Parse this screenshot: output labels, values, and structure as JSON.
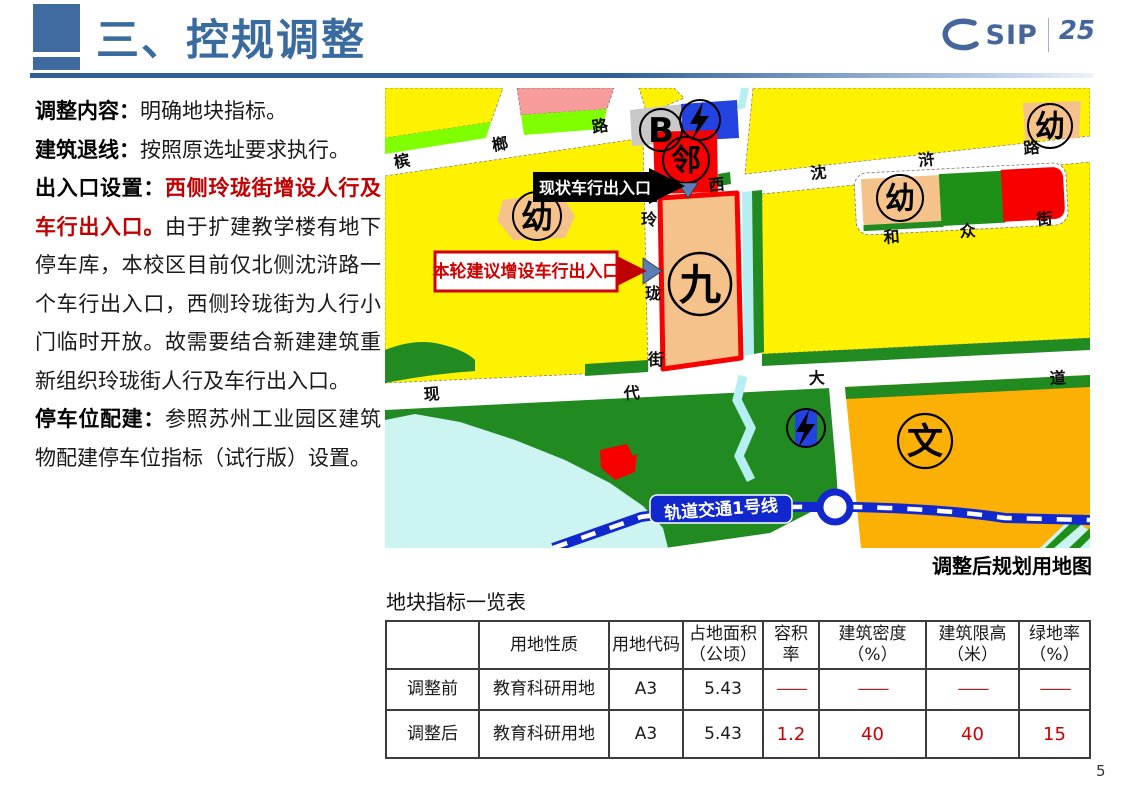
{
  "header": {
    "title": "三、控规调整",
    "logo_brand": "SIP",
    "logo_anniversary": "25"
  },
  "left_column": {
    "paragraphs": [
      {
        "segments": [
          {
            "t": "调整内容：",
            "s": "bold"
          },
          {
            "t": "明确地块指标。",
            "s": "normal"
          }
        ]
      },
      {
        "segments": [
          {
            "t": "建筑退线：",
            "s": "bold"
          },
          {
            "t": "按照原选址要求执行。",
            "s": "normal"
          }
        ]
      },
      {
        "segments": [
          {
            "t": "出入口设置：",
            "s": "bold"
          },
          {
            "t": "西侧玲珑街增设人行及车行出入口。",
            "s": "redbold"
          },
          {
            "t": "由于扩建教学楼有地下停车库，本校区目前仅北侧沈浒路一个车行出入口，西侧玲珑街为人行小门临时开放。故需要结合新建建筑重新组织玲珑街人行及车行出入口。",
            "s": "normal"
          }
        ]
      },
      {
        "segments": [
          {
            "t": "停车位配建：",
            "s": "bold"
          },
          {
            "t": "参照苏州工业园区建筑物配建停车位指标（试行版）设置。",
            "s": "normal"
          }
        ]
      }
    ]
  },
  "map": {
    "caption": "调整后规划用地图",
    "callouts": {
      "existing": "现状车行出入口",
      "proposed": "本轮建议增设车行出入口"
    },
    "metro_line": "轨道交通1号线",
    "roads": {
      "binglang": [
        "槟",
        "榔",
        "路"
      ],
      "xishenhu": [
        "西",
        "沈",
        "浒",
        "路"
      ],
      "linglong": [
        "玲",
        "珑",
        "街"
      ],
      "hezhong": [
        "和",
        "众",
        "街"
      ],
      "xiandai": [
        "现",
        "代",
        "大",
        "道"
      ]
    },
    "markers": {
      "b": "B",
      "lin": "邻",
      "you": "幼",
      "jiu": "九",
      "wen": "文"
    },
    "colors": {
      "yellow": "#fff200",
      "bright_green": "#80ff00",
      "park_green": "#218a21",
      "peach": "#f5c28c",
      "orange": "#fcaf04",
      "red": "#f90000",
      "pink": "#f79b9b",
      "water": "#ccf4f0",
      "metro_blue": "#1128ce",
      "gray": "#c9c9c9",
      "callout_red": "#c00000",
      "triangle_blue": "#5b7fb5"
    }
  },
  "table": {
    "title": "地块指标一览表",
    "headers": [
      {
        "line1": "",
        "line2": ""
      },
      {
        "line1": "用地性质",
        "line2": ""
      },
      {
        "line1": "用地代码",
        "line2": ""
      },
      {
        "line1": "占地面积",
        "line2": "（公顷）"
      },
      {
        "line1": "容积率",
        "line2": ""
      },
      {
        "line1": "建筑密度",
        "line2": "（%）"
      },
      {
        "line1": "建筑限高",
        "line2": "（米）"
      },
      {
        "line1": "绿地率",
        "line2": "（%）"
      }
    ],
    "rows": [
      {
        "label": "调整前",
        "cells": [
          "教育科研用地",
          "A3",
          "5.43",
          "——",
          "——",
          "——",
          "——"
        ]
      },
      {
        "label": "调整后",
        "cells": [
          "教育科研用地",
          "A3",
          "5.43",
          "1.2",
          "40",
          "40",
          "15"
        ]
      }
    ]
  },
  "page_number": "5"
}
